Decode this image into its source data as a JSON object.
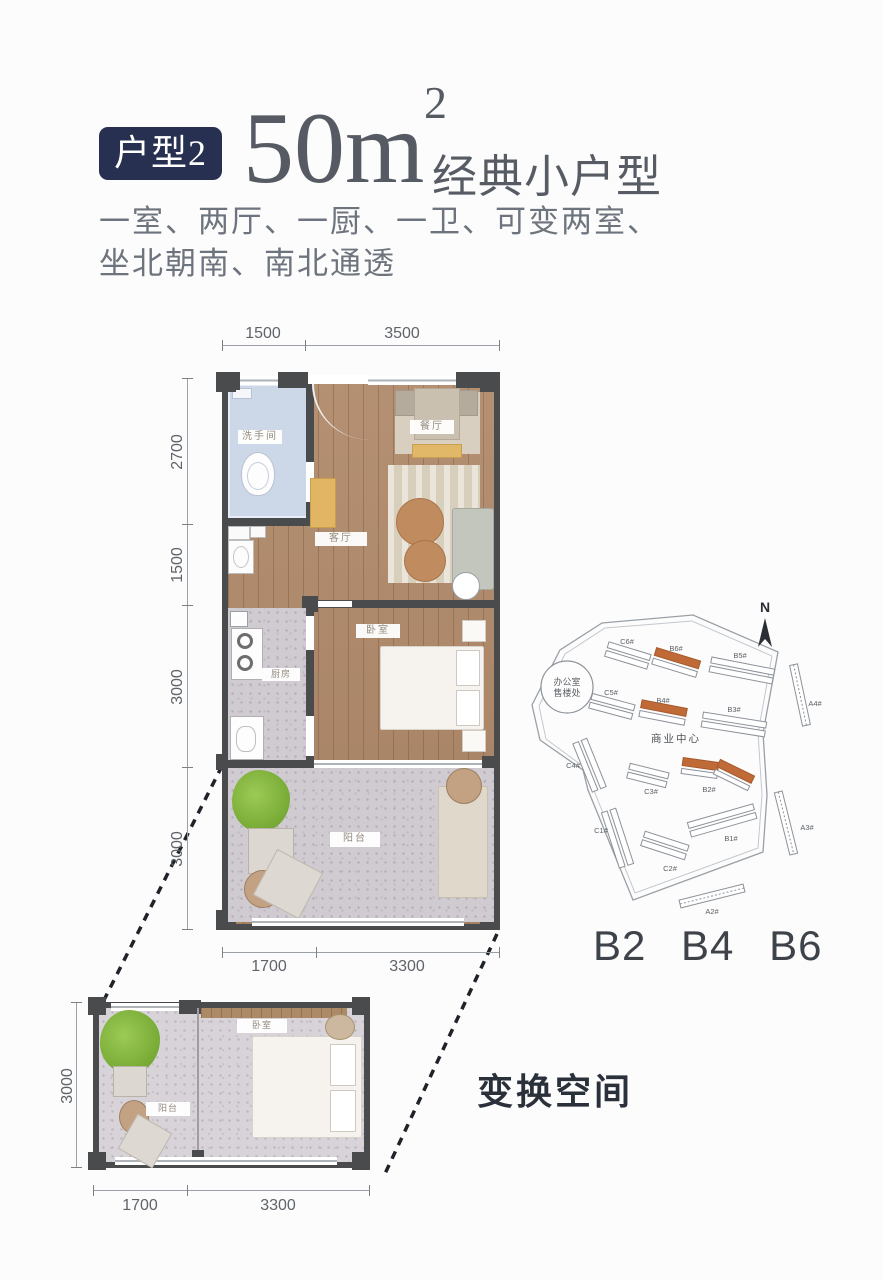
{
  "header": {
    "badge": "户型2",
    "area_value": "50m",
    "area_sup": "2",
    "area_tagline": "经典小户型",
    "desc_line1": "一室、两厅、一厨、一卫、可变两室、",
    "desc_line2": "坐北朝南、南北通透"
  },
  "main_plan": {
    "dims": {
      "top": [
        "1500",
        "3500"
      ],
      "left": [
        "2700",
        "1500",
        "3000",
        "3000"
      ],
      "bottom": [
        "1700",
        "3300"
      ]
    },
    "rooms": {
      "bathroom": "洗手间",
      "dining": "餐厅",
      "living": "客厅",
      "kitchen": "厨房",
      "bedroom": "卧室",
      "balcony": "阳台"
    }
  },
  "site_plan": {
    "compass": "N",
    "office_line1": "办公室",
    "office_line2": "售楼处",
    "center_label": "商业中心",
    "buildings": {
      "c6": "C6#",
      "b6": "B6#",
      "b5": "B5#",
      "c5": "C5#",
      "b4": "B4#",
      "b3": "B3#",
      "a4": "A4#",
      "c4": "C4#",
      "c3": "C3#",
      "b2": "B2#",
      "c1": "C1#",
      "c2": "C2#",
      "b1": "B1#",
      "a3": "A3#",
      "a2": "A2#"
    },
    "caption": "B2 B4 B6"
  },
  "small_plan": {
    "dims": {
      "left": "3000",
      "bottom": [
        "1700",
        "3300"
      ]
    },
    "rooms": {
      "bedroom": "卧室",
      "balcony": "阳台"
    }
  },
  "callout": {
    "label": "变换空间"
  },
  "colors": {
    "badge_navy": "#273050",
    "accent_orange": "#c06a38",
    "wall_dark": "#4a4b4d",
    "wood": "#b0896a",
    "bathroom_blue": "#ccd7e8",
    "terrazzo": "#cfcbd1",
    "plant_green": "#85bb41"
  }
}
